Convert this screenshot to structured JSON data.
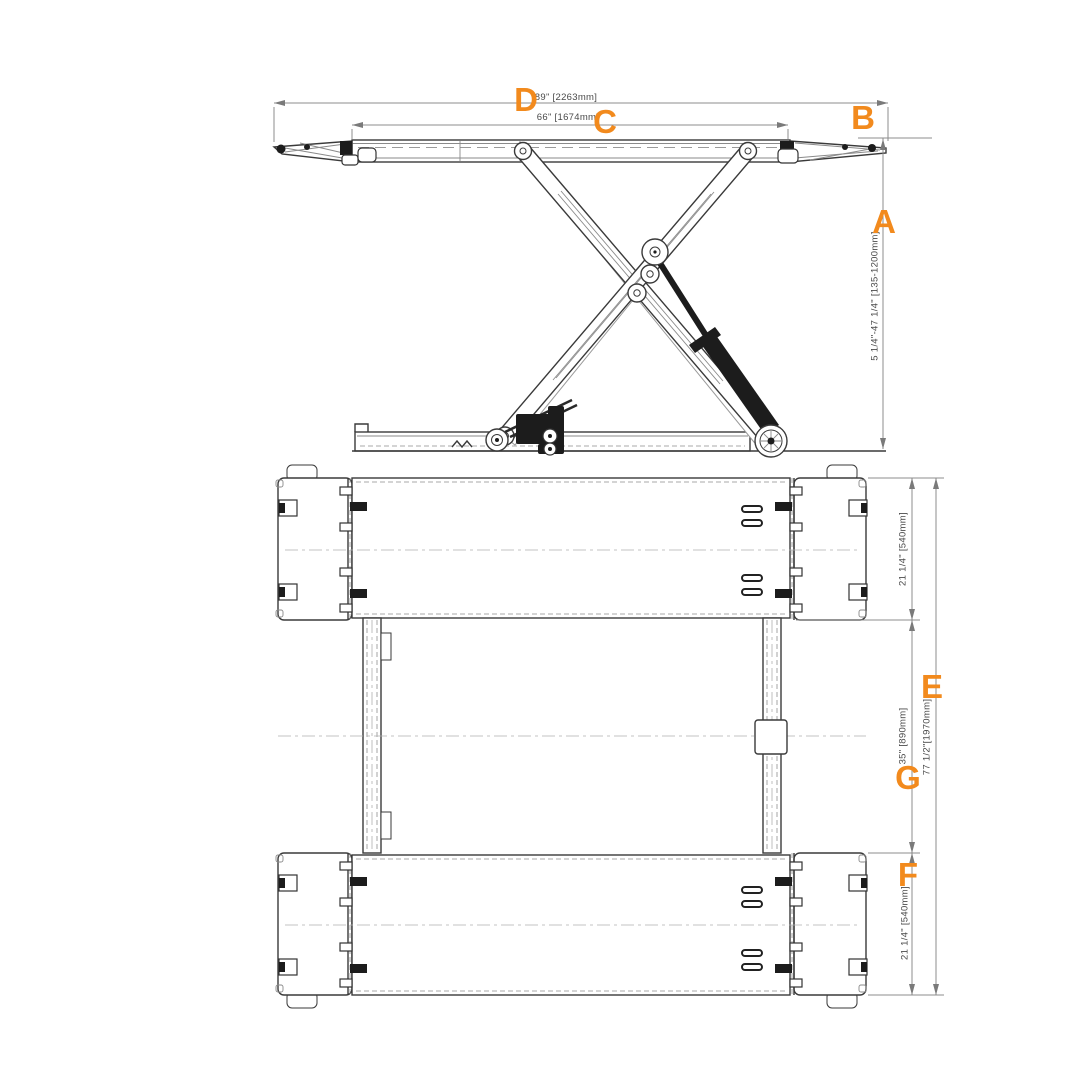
{
  "colors": {
    "accent": "#F28A1D",
    "line": "#3A3A3A",
    "dimension_line": "#8C8C8C",
    "dimension_text": "#4A4A4A",
    "background": "#FFFFFF"
  },
  "side_view": {
    "dim_d": {
      "letter": "D",
      "text": "89\" [2263mm]"
    },
    "dim_c": {
      "letter": "C",
      "text": "66\" [1674mm]"
    },
    "dim_b": {
      "letter": "B"
    },
    "dim_a": {
      "letter": "A",
      "text": "5 1/4\"-47 1/4\" [135-1200mm]"
    }
  },
  "plan_view": {
    "dim_top_platform": {
      "text": "21 1/4\" [540mm]"
    },
    "dim_e": {
      "letter": "E",
      "text": "77 1/2\"[1970mm]"
    },
    "dim_g": {
      "letter": "G",
      "text": "35\" [890mm]"
    },
    "dim_f": {
      "letter": "F",
      "text": "21 1/4\" [540mm]"
    }
  }
}
